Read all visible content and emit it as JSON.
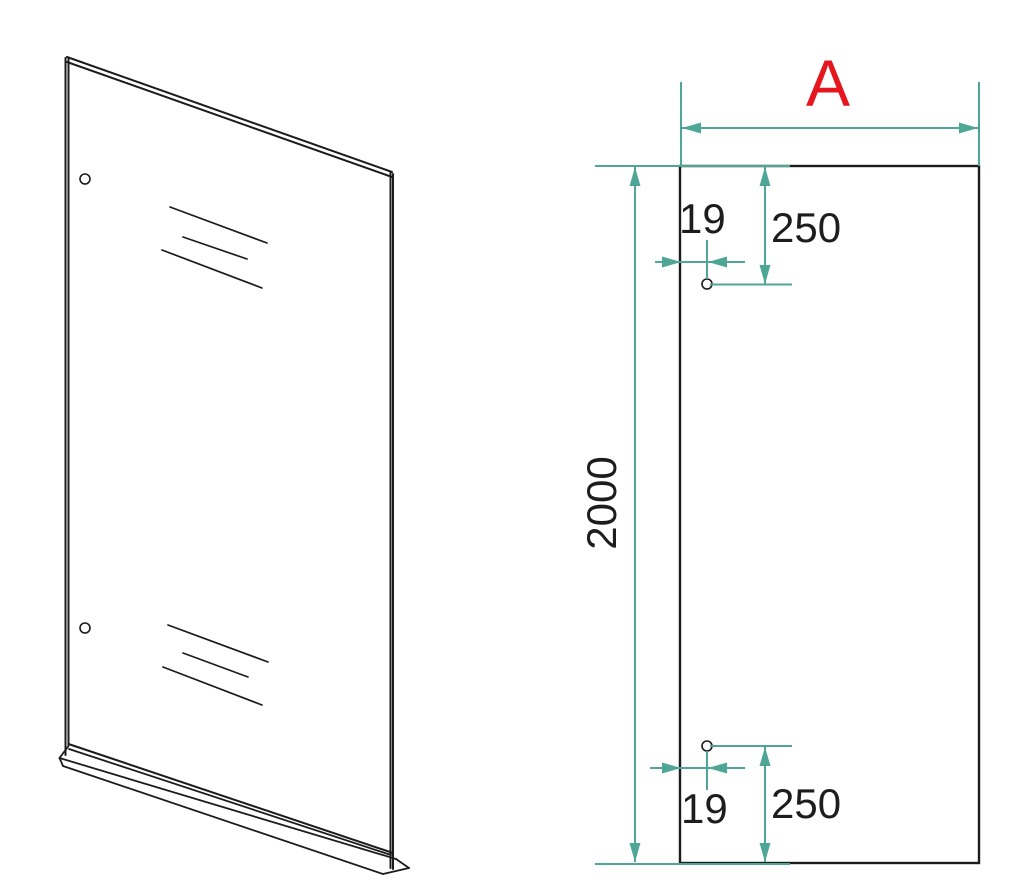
{
  "drawing": {
    "panel_width_label": "A",
    "panel_height": "2000",
    "hole_top": {
      "edge_offset": "19",
      "top_offset": "250"
    },
    "hole_bottom": {
      "edge_offset": "19",
      "bottom_offset": "250"
    }
  },
  "colors": {
    "dimension_line": "#4ea796",
    "width_label_accent": "#e6161e",
    "drawing_line": "#1c1c1c",
    "text": "#1d1d1d"
  }
}
